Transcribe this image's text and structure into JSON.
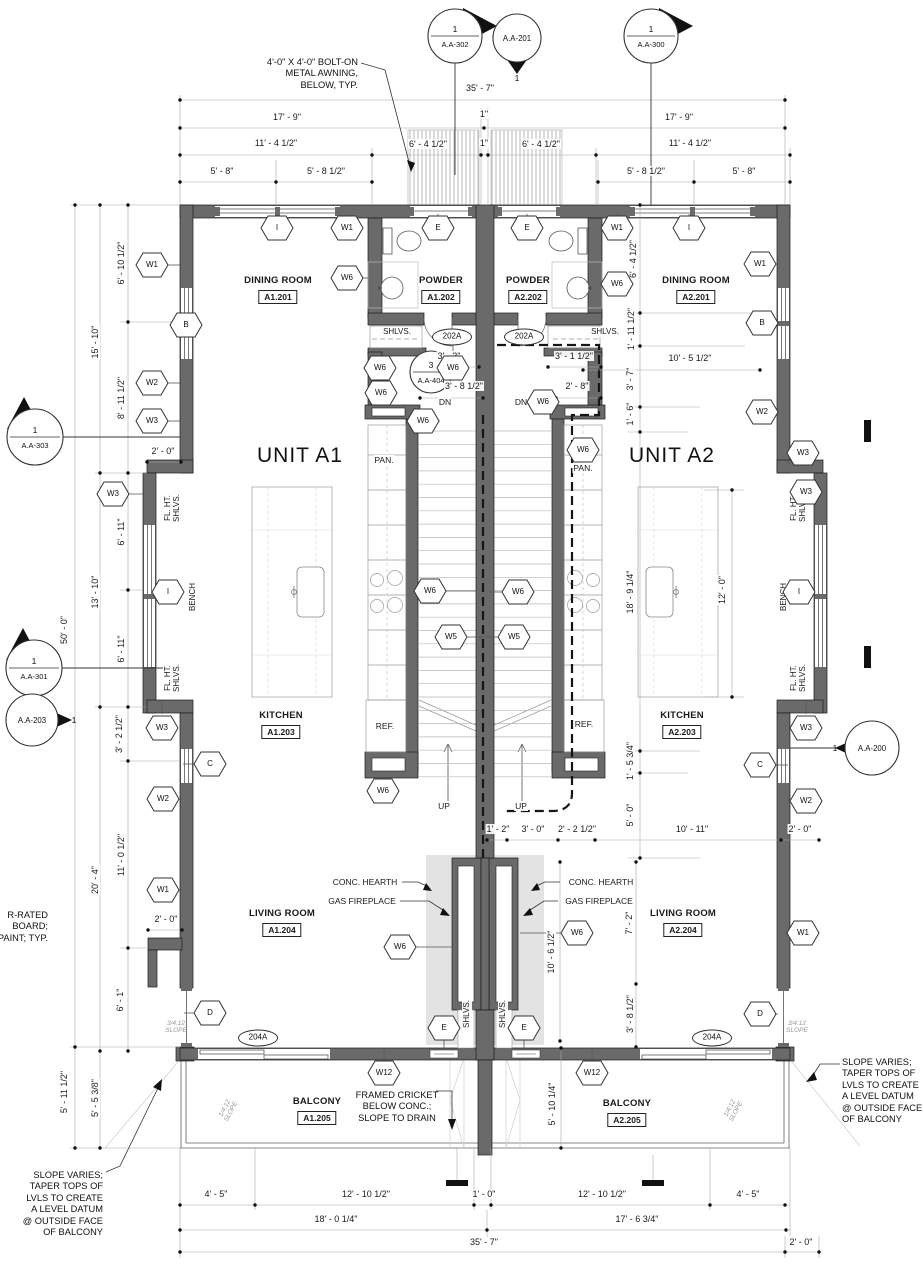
{
  "units": [
    {
      "label": "UNIT A1",
      "x": 300,
      "y": 456
    },
    {
      "label": "UNIT A2",
      "x": 672,
      "y": 456
    }
  ],
  "rooms": [
    {
      "name": "DINING ROOM",
      "number": "A1.201",
      "x": 278,
      "y": 281
    },
    {
      "name": "POWDER",
      "number": "A1.202",
      "x": 441,
      "y": 281
    },
    {
      "name": "POWDER",
      "number": "A2.202",
      "x": 528,
      "y": 281
    },
    {
      "name": "DINING ROOM",
      "number": "A2.201",
      "x": 696,
      "y": 281
    },
    {
      "name": "KITCHEN",
      "number": "A1.203",
      "x": 281,
      "y": 716
    },
    {
      "name": "KITCHEN",
      "number": "A2.203",
      "x": 682,
      "y": 716
    },
    {
      "name": "LIVING ROOM",
      "number": "A1.204",
      "x": 282,
      "y": 914
    },
    {
      "name": "LIVING ROOM",
      "number": "A2.204",
      "x": 683,
      "y": 914
    },
    {
      "name": "BALCONY",
      "number": "A1.205",
      "x": 317,
      "y": 1102
    },
    {
      "name": "BALCONY",
      "number": "A2.205",
      "x": 627,
      "y": 1104
    }
  ],
  "dimensions": [
    {
      "t": "35' - 7\"",
      "x": 480,
      "y": 88
    },
    {
      "t": "17' - 9\"",
      "x": 287,
      "y": 117
    },
    {
      "t": "1\"",
      "x": 484,
      "y": 114
    },
    {
      "t": "17' - 9\"",
      "x": 679,
      "y": 117
    },
    {
      "t": "11' - 4 1/2\"",
      "x": 276,
      "y": 143
    },
    {
      "t": "6' - 4 1/2\"",
      "x": 428,
      "y": 144
    },
    {
      "t": "1\"",
      "x": 484,
      "y": 143
    },
    {
      "t": "6' - 4 1/2\"",
      "x": 541,
      "y": 144
    },
    {
      "t": "11' - 4 1/2\"",
      "x": 690,
      "y": 143
    },
    {
      "t": "5' - 8\"",
      "x": 222,
      "y": 171
    },
    {
      "t": "5' - 8 1/2\"",
      "x": 326,
      "y": 171
    },
    {
      "t": "5' - 8 1/2\"",
      "x": 646,
      "y": 171
    },
    {
      "t": "5' - 8\"",
      "x": 744,
      "y": 171
    },
    {
      "t": "6' - 10 1/2\"",
      "x": 121,
      "y": 263,
      "r": 1
    },
    {
      "t": "15' - 10\"",
      "x": 95,
      "y": 342,
      "r": 1
    },
    {
      "t": "8' - 11 1/2\"",
      "x": 121,
      "y": 398,
      "r": 1
    },
    {
      "t": "50' - 0\"",
      "x": 64,
      "y": 630,
      "r": 1
    },
    {
      "t": "13' - 10\"",
      "x": 95,
      "y": 592,
      "r": 1
    },
    {
      "t": "6' - 11\"",
      "x": 121,
      "y": 532,
      "r": 1
    },
    {
      "t": "6' - 11\"",
      "x": 121,
      "y": 649,
      "r": 1
    },
    {
      "t": "3' - 2 1/2\"",
      "x": 119,
      "y": 734,
      "r": 1
    },
    {
      "t": "11' - 0 1/2\"",
      "x": 121,
      "y": 855,
      "r": 1
    },
    {
      "t": "20' - 4\"",
      "x": 95,
      "y": 880,
      "r": 1
    },
    {
      "t": "6' - 1\"",
      "x": 120,
      "y": 1000,
      "r": 1
    },
    {
      "t": "5' - 11 1/2\"",
      "x": 64,
      "y": 1092,
      "r": 1
    },
    {
      "t": "5' - 5 3/8\"",
      "x": 95,
      "y": 1098,
      "r": 1
    },
    {
      "t": "2' - 0\"",
      "x": 163,
      "y": 451
    },
    {
      "t": "2' - 0\"",
      "x": 166,
      "y": 919
    },
    {
      "t": "3' - 3\"",
      "x": 449,
      "y": 356
    },
    {
      "t": "3' - 1 1/2\"",
      "x": 574,
      "y": 356
    },
    {
      "t": "3' - 8 1/2\"",
      "x": 464,
      "y": 386
    },
    {
      "t": "2' - 8\"",
      "x": 577,
      "y": 386
    },
    {
      "t": "6' - 4 1/2\"",
      "x": 633,
      "y": 259,
      "r": 1
    },
    {
      "t": "1' - 11 1/2\"",
      "x": 631,
      "y": 329,
      "r": 1
    },
    {
      "t": "3' - 7\"",
      "x": 630,
      "y": 379,
      "r": 1
    },
    {
      "t": "1' - 6\"",
      "x": 630,
      "y": 414,
      "r": 1
    },
    {
      "t": "10' - 5 1/2\"",
      "x": 690,
      "y": 358
    },
    {
      "t": "18' - 9 1/4\"",
      "x": 630,
      "y": 592,
      "r": 1
    },
    {
      "t": "12' - 0\"",
      "x": 722,
      "y": 590,
      "r": 1
    },
    {
      "t": "1' - 5 3/4\"",
      "x": 630,
      "y": 761,
      "r": 1
    },
    {
      "t": "5' - 0\"",
      "x": 630,
      "y": 815,
      "r": 1
    },
    {
      "t": "1' - 2\"",
      "x": 498,
      "y": 829
    },
    {
      "t": "3' - 0\"",
      "x": 533,
      "y": 829
    },
    {
      "t": "2' - 2 1/2\"",
      "x": 577,
      "y": 829
    },
    {
      "t": "10' - 11\"",
      "x": 692,
      "y": 829
    },
    {
      "t": "2' - 0\"",
      "x": 800,
      "y": 829
    },
    {
      "t": "7' - 2\"",
      "x": 629,
      "y": 923,
      "r": 1
    },
    {
      "t": "10' - 6 1/2\"",
      "x": 551,
      "y": 952,
      "r": 1
    },
    {
      "t": "3' - 8 1/2\"",
      "x": 630,
      "y": 1014,
      "r": 1
    },
    {
      "t": "5' - 10 1/4\"",
      "x": 552,
      "y": 1104,
      "r": 1
    },
    {
      "t": "4' - 5\"",
      "x": 216,
      "y": 1194
    },
    {
      "t": "12' - 10 1/2\"",
      "x": 366,
      "y": 1194
    },
    {
      "t": "1' - 0\"",
      "x": 484,
      "y": 1194
    },
    {
      "t": "12' - 10 1/2\"",
      "x": 602,
      "y": 1194
    },
    {
      "t": "4' - 5\"",
      "x": 748,
      "y": 1194
    },
    {
      "t": "18' - 0 1/4\"",
      "x": 336,
      "y": 1219
    },
    {
      "t": "17' - 6 3/4\"",
      "x": 637,
      "y": 1219
    },
    {
      "t": "35' - 7\"",
      "x": 484,
      "y": 1242
    },
    {
      "t": "2' - 0\"",
      "x": 801,
      "y": 1242
    }
  ],
  "hex_tags": [
    {
      "t": "I",
      "x": 277,
      "y": 228
    },
    {
      "t": "W1",
      "x": 347,
      "y": 228
    },
    {
      "t": "E",
      "x": 438,
      "y": 228
    },
    {
      "t": "E",
      "x": 527,
      "y": 228
    },
    {
      "t": "W1",
      "x": 617,
      "y": 228
    },
    {
      "t": "I",
      "x": 689,
      "y": 228
    },
    {
      "t": "W1",
      "x": 152,
      "y": 265
    },
    {
      "t": "B",
      "x": 186,
      "y": 325
    },
    {
      "t": "W2",
      "x": 152,
      "y": 383
    },
    {
      "t": "W3",
      "x": 152,
      "y": 421
    },
    {
      "t": "W3",
      "x": 113,
      "y": 494
    },
    {
      "t": "I",
      "x": 168,
      "y": 592
    },
    {
      "t": "W3",
      "x": 162,
      "y": 728
    },
    {
      "t": "C",
      "x": 210,
      "y": 764
    },
    {
      "t": "W2",
      "x": 163,
      "y": 799
    },
    {
      "t": "W1",
      "x": 163,
      "y": 890
    },
    {
      "t": "D",
      "x": 210,
      "y": 1013
    },
    {
      "t": "W1",
      "x": 760,
      "y": 264
    },
    {
      "t": "B",
      "x": 762,
      "y": 323
    },
    {
      "t": "W2",
      "x": 762,
      "y": 412
    },
    {
      "t": "W3",
      "x": 803,
      "y": 453
    },
    {
      "t": "W3",
      "x": 806,
      "y": 492
    },
    {
      "t": "I",
      "x": 799,
      "y": 592
    },
    {
      "t": "W3",
      "x": 806,
      "y": 728
    },
    {
      "t": "C",
      "x": 760,
      "y": 765
    },
    {
      "t": "W2",
      "x": 806,
      "y": 801
    },
    {
      "t": "W1",
      "x": 803,
      "y": 933
    },
    {
      "t": "D",
      "x": 760,
      "y": 1014
    },
    {
      "t": "W6",
      "x": 347,
      "y": 278
    },
    {
      "t": "W6",
      "x": 617,
      "y": 284
    },
    {
      "t": "W6",
      "x": 380,
      "y": 368
    },
    {
      "t": "W6",
      "x": 453,
      "y": 368
    },
    {
      "t": "W6",
      "x": 381,
      "y": 393
    },
    {
      "t": "W6",
      "x": 543,
      "y": 402
    },
    {
      "t": "W6",
      "x": 423,
      "y": 421
    },
    {
      "t": "W6",
      "x": 583,
      "y": 450
    },
    {
      "t": "W6",
      "x": 430,
      "y": 591
    },
    {
      "t": "W6",
      "x": 518,
      "y": 592
    },
    {
      "t": "W5",
      "x": 451,
      "y": 637
    },
    {
      "t": "W5",
      "x": 514,
      "y": 637
    },
    {
      "t": "W6",
      "x": 383,
      "y": 791
    },
    {
      "t": "W6",
      "x": 400,
      "y": 947
    },
    {
      "t": "W6",
      "x": 577,
      "y": 933
    },
    {
      "t": "W12",
      "x": 384,
      "y": 1073
    },
    {
      "t": "W12",
      "x": 592,
      "y": 1073
    },
    {
      "t": "E",
      "x": 444,
      "y": 1028
    },
    {
      "t": "E",
      "x": 524,
      "y": 1028
    }
  ],
  "oval_tags": [
    {
      "t": "202A",
      "x": 452,
      "y": 337
    },
    {
      "t": "202A",
      "x": 524,
      "y": 337
    },
    {
      "t": "204A",
      "x": 258,
      "y": 1038
    },
    {
      "t": "204A",
      "x": 712,
      "y": 1038
    }
  ],
  "section_markers": [
    {
      "num": "1",
      "sheet": "A.A-302",
      "x": 455,
      "y": 36,
      "rad": 27,
      "tri": "right",
      "split": 1
    },
    {
      "num": "1",
      "sheet": "A.A-300",
      "x": 651,
      "y": 36,
      "rad": 27,
      "tri": "right",
      "split": 1
    },
    {
      "num": "1",
      "sheet": "A.A-201",
      "x": 517,
      "y": 38,
      "rad": 24,
      "tri": "down",
      "split": 0,
      "nx": 517,
      "ny": 78
    },
    {
      "num": "1",
      "sheet": "A.A-303",
      "x": 35,
      "y": 437,
      "rad": 28,
      "tri": "up",
      "split": 1
    },
    {
      "num": "1",
      "sheet": "A.A-301",
      "x": 34,
      "y": 668,
      "rad": 28,
      "tri": "up",
      "split": 1
    },
    {
      "num": "1",
      "sheet": "A.A-203",
      "x": 32,
      "y": 720,
      "rad": 26,
      "tri": "right-small",
      "split": 0,
      "nx": 74,
      "ny": 720
    },
    {
      "num": "1",
      "sheet": "A.A-200",
      "x": 872,
      "y": 748,
      "rad": 27,
      "tri": "left-small",
      "split": 0,
      "nx": 835,
      "ny": 748
    },
    {
      "num": "3",
      "sheet": "A.A-404",
      "x": 431,
      "y": 372,
      "rad": 21,
      "tri": "none",
      "split": 1
    }
  ],
  "fixture_labels": [
    {
      "t": "SHLVS.",
      "x": 397,
      "y": 332,
      "c": "xs"
    },
    {
      "t": "SHLVS.",
      "x": 605,
      "y": 332,
      "c": "xs"
    },
    {
      "t": "PAN.",
      "x": 384,
      "y": 460,
      "c": "sm"
    },
    {
      "t": "PAN.",
      "x": 583,
      "y": 468,
      "c": "sm"
    },
    {
      "t": "REF.",
      "x": 385,
      "y": 726,
      "c": "sm"
    },
    {
      "t": "REF.",
      "x": 584,
      "y": 724,
      "c": "sm"
    },
    {
      "t": "DN",
      "x": 445,
      "y": 402,
      "c": "sm"
    },
    {
      "t": "DN",
      "x": 521,
      "y": 402,
      "c": "sm"
    },
    {
      "t": "UP",
      "x": 444,
      "y": 806,
      "c": "sm"
    },
    {
      "t": "UP",
      "x": 521,
      "y": 806,
      "c": "sm"
    },
    {
      "t": "BENCH",
      "x": 193,
      "y": 597,
      "c": "xs r90"
    },
    {
      "t": "BENCH",
      "x": 784,
      "y": 597,
      "c": "xs r90"
    },
    {
      "t": "FL. HT.\nSHLVS.",
      "x": 172,
      "y": 508,
      "c": "xs r90 pre"
    },
    {
      "t": "FL. HT.\nSHLVS.",
      "x": 172,
      "y": 678,
      "c": "xs r90 pre"
    },
    {
      "t": "FL. HT.\nSHLVS.",
      "x": 798,
      "y": 508,
      "c": "xs r90 pre"
    },
    {
      "t": "FL. HT.\nSHLVS.",
      "x": 798,
      "y": 678,
      "c": "xs r90 pre"
    },
    {
      "t": "SHLVS.",
      "x": 467,
      "y": 1014,
      "c": "xs r90"
    },
    {
      "t": "SHLVS.",
      "x": 503,
      "y": 1014,
      "c": "xs r90"
    },
    {
      "t": "CONC. HEARTH",
      "x": 365,
      "y": 882,
      "c": "sm"
    },
    {
      "t": "GAS FIREPLACE",
      "x": 362,
      "y": 901,
      "c": "sm"
    },
    {
      "t": "CONC. HEARTH",
      "x": 601,
      "y": 882,
      "c": "sm"
    },
    {
      "t": "GAS FIREPLACE",
      "x": 599,
      "y": 901,
      "c": "sm"
    },
    {
      "t": "3/4:12\nSLOPE",
      "x": 176,
      "y": 1027,
      "c": "slope pre"
    },
    {
      "t": "3/4:12\nSLOPE",
      "x": 797,
      "y": 1027,
      "c": "slope pre"
    },
    {
      "t": "1/4:12\nSLOPE",
      "x": 228,
      "y": 1110,
      "c": "slope pre r62"
    },
    {
      "t": "1/4:12\nSLOPE",
      "x": 733,
      "y": 1110,
      "c": "slope pre r62"
    }
  ],
  "notes": [
    {
      "name": "awning-note",
      "text": "4'-0\" X 4'-0\" BOLT-ON\nMETAL AWNING,\nBELOW, TYP.",
      "x": 358,
      "y": 57,
      "align": "right"
    },
    {
      "name": "cricket-note",
      "text": "FRAMED CRICKET\nBELOW CONC.;\nSLOPE TO DRAIN",
      "x": 397,
      "y": 1090,
      "align": "center"
    },
    {
      "name": "slope-note-left",
      "text": "SLOPE VARIES;\nTAPER TOPS OF\nLVLS TO CREATE\nA LEVEL DATUM\n@ OUTSIDE FACE\nOF BALCONY",
      "x": 103,
      "y": 1170,
      "align": "right"
    },
    {
      "name": "slope-note-right",
      "text": "SLOPE VARIES;\nTAPER TOPS OF\nLVLS TO CREATE\nA LEVEL DATUM\n@ OUTSIDE FACE\nOF BALCONY",
      "x": 842,
      "y": 1057,
      "align": "left"
    },
    {
      "name": "wall-note-clipped",
      "text": "R-RATED\nBOARD;\nPAINT; TYP.",
      "x": 48,
      "y": 910,
      "align": "right"
    }
  ]
}
